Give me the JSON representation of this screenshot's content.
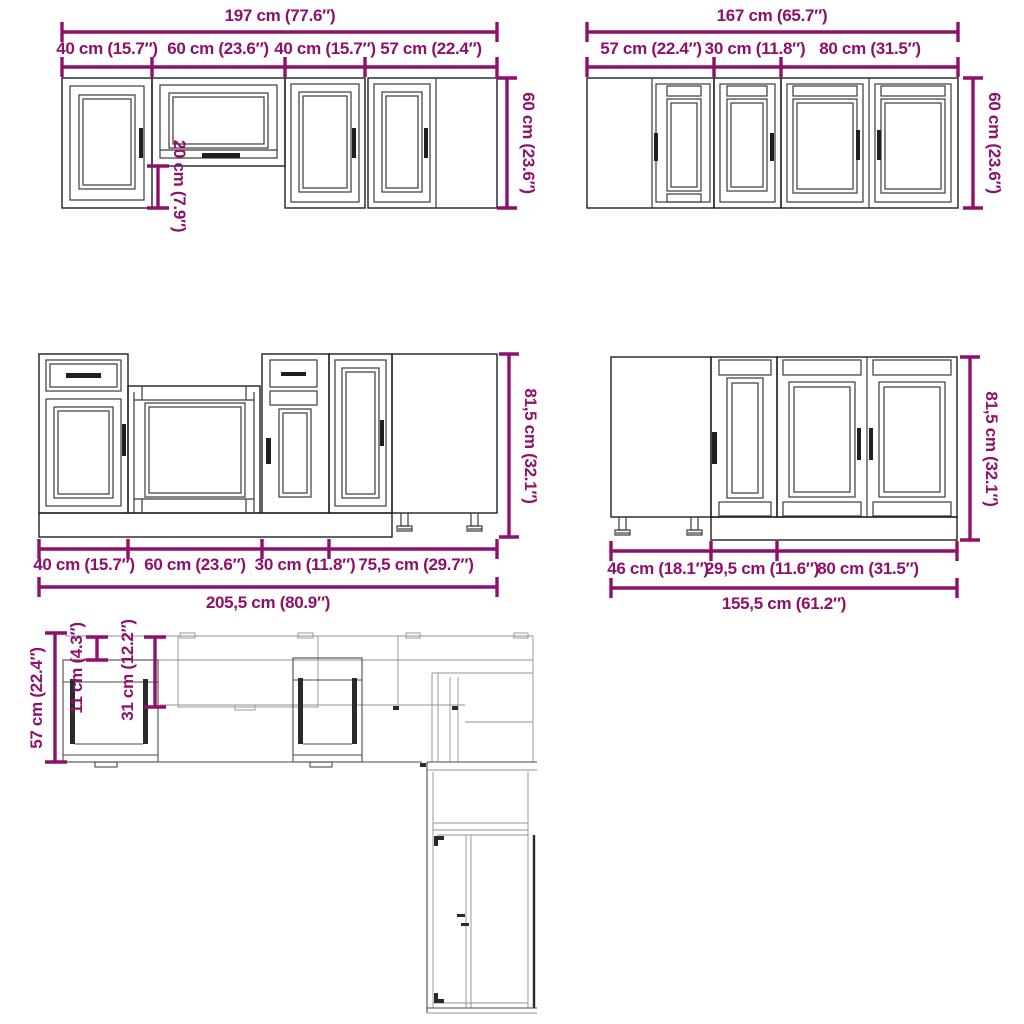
{
  "title": "Kitchen cabinet set dimension diagram",
  "colors": {
    "dimension": "#8f106c",
    "line": "#1f1f1f"
  },
  "diagrams": {
    "wall_run_a": {
      "total": "197 cm (77.6″)",
      "segments": [
        "40 cm (15.7″)",
        "60 cm (23.6″)",
        "40 cm (15.7″)",
        "57 cm (22.4″)"
      ],
      "height": "60 cm (23.6″)",
      "flip_drop": "20 cm (7.9″)"
    },
    "wall_run_b": {
      "total": "167 cm (65.7″)",
      "segments": [
        "57 cm (22.4″)",
        "30 cm (11.8″)",
        "80 cm (31.5″)"
      ],
      "height": "60 cm (23.6″)"
    },
    "base_run_a": {
      "total": "205,5 cm (80.9″)",
      "segments": [
        "40 cm (15.7″)",
        "60 cm (23.6″)",
        "30 cm (11.8″)",
        "75,5 cm (29.7″)"
      ],
      "height": "81,5 cm (32.1″)"
    },
    "base_run_b": {
      "total": "155,5 cm (61.2″)",
      "segments": [
        "46 cm (18.1″)",
        "29,5 cm (11.6″)",
        "80 cm (31.5″)"
      ],
      "height": "81,5 cm (32.1″)"
    },
    "plan_view": {
      "depth": "57 cm (22.4″)",
      "back_offset": "11 cm (4.3″)",
      "wall_depth": "31 cm (12.2″)"
    }
  }
}
